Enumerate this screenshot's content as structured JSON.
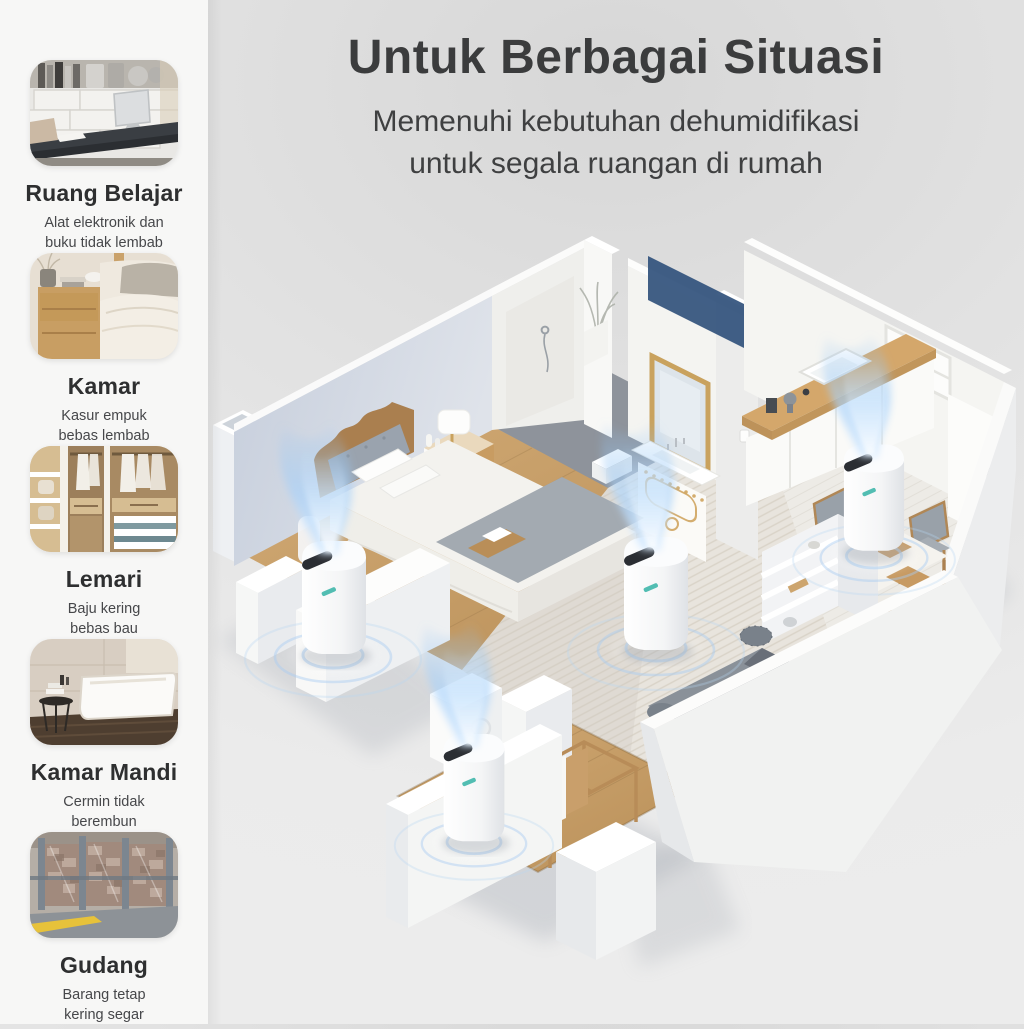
{
  "header": {
    "title": "Untuk Berbagai Situasi",
    "subtitle_line1": "Memenuhi kebutuhan dehumidifikasi",
    "subtitle_line2": "untuk segala ruangan di rumah"
  },
  "sidebar": {
    "items": [
      {
        "title": "Ruang Belajar",
        "desc1": "Alat elektronik dan",
        "desc2": "buku tidak lembab"
      },
      {
        "title": "Kamar",
        "desc1": "Kasur empuk",
        "desc2": "bebas lembab"
      },
      {
        "title": "Lemari",
        "desc1": "Baju kering",
        "desc2": "bebas bau"
      },
      {
        "title": "Kamar Mandi",
        "desc1": "Cermin tidak",
        "desc2": "berembun"
      },
      {
        "title": "Gudang",
        "desc1": "Barang tetap",
        "desc2": "kering segar"
      }
    ]
  },
  "illustration": {
    "mist_color": "#aed5ff",
    "ripple_color": "#9cc4ee",
    "wood_color": "#c9a26d",
    "wall_lit": "#f6f6f4",
    "wall_shadow": "#dfe3e9",
    "cast_shadow_navy": "#31517c",
    "background_gray": "#e2e2e2",
    "sidebar_bg": "#f7f7f6"
  }
}
